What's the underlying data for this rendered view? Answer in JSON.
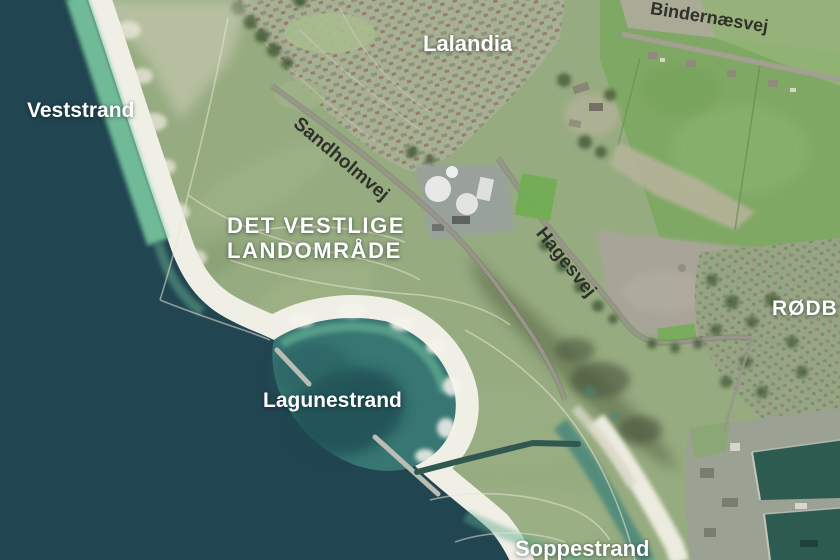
{
  "map": {
    "kind": "aerial-photo-map",
    "place_labels": {
      "veststrand": "Veststrand",
      "lalandia": "Lalandia",
      "det_vestlige_line1": "DET VESTLIGE",
      "det_vestlige_line2": "LANDOMRÅDE",
      "lagunestrand": "Lagunestrand",
      "soppestrand": "Soppestrand",
      "roedby_partial": "RØDB"
    },
    "road_labels": {
      "bindernaesvej": "Bindernæsvej",
      "sandholmvej": "Sandholmvej",
      "hagesvej": "Hagesvej"
    },
    "palette": {
      "sea_deep": "#214551",
      "sea_shallow": "#79c7a0",
      "lagoon_water": "#3a7d77",
      "beach_sand": "#f0efe6",
      "meadow_green": "#96ab80",
      "field_green": "#7fa864",
      "fallow_grey": "#a8a598",
      "label_light": "#ffffff",
      "label_dark": "#30302a"
    }
  }
}
